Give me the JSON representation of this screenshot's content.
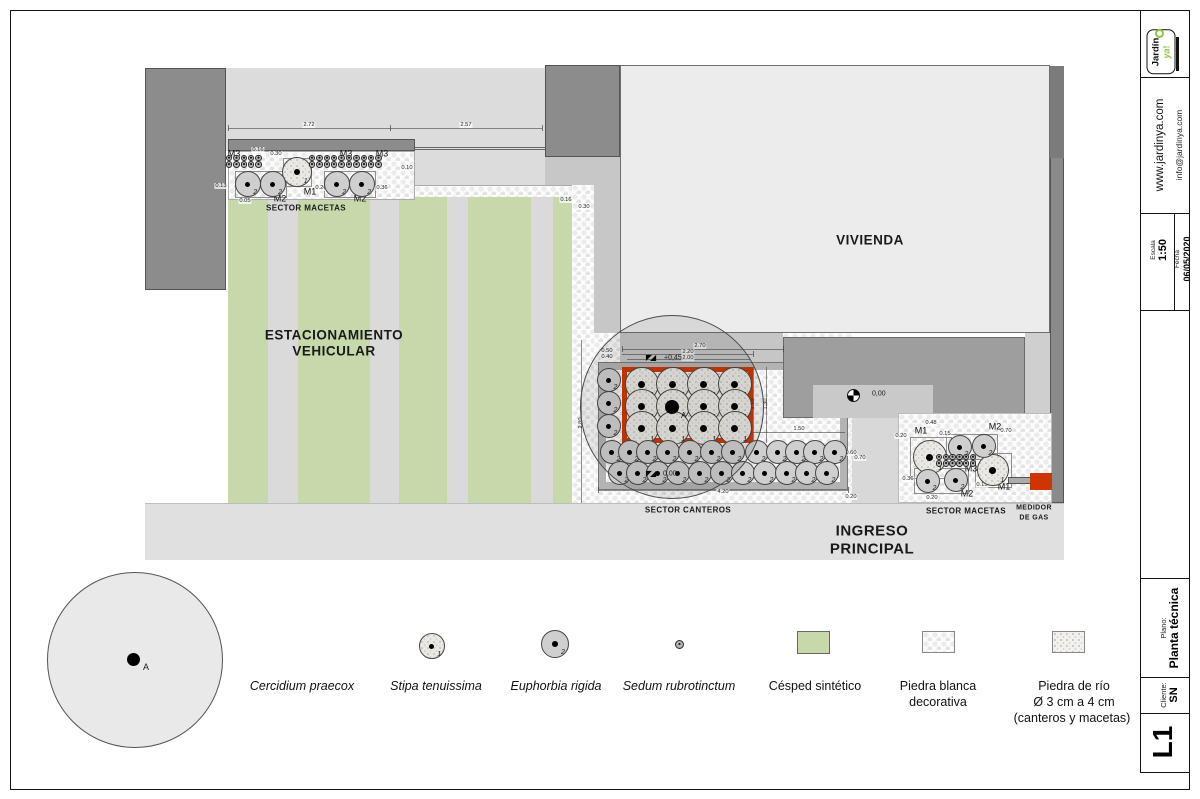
{
  "title_block": {
    "logo_text": "Jardín",
    "logo_accent": "ya",
    "logo_bang": "!",
    "website": "www.jardinya.com",
    "email": "info@jardinya.com",
    "escala_label": "Escala",
    "escala_value": "1:50",
    "fecha_label": "Fecha",
    "fecha_value": "06/05/2020",
    "plano_label": "Plano:",
    "plano_value": "Planta técnica",
    "cliente_label": "Cliente:",
    "cliente_value": "SN",
    "sheet_code": "L1",
    "accent_green": "#8dc63f"
  },
  "plan": {
    "areas": {
      "vivienda": "VIVIENDA",
      "est_l1": "ESTACIONAMIENTO",
      "est_l2": "VEHICULAR",
      "ingreso_l1": "INGRESO",
      "ingreso_l2": "PRINCIPAL",
      "sector_macetas_left": "SECTOR MACETAS",
      "sector_canteros": "SECTOR CANTEROS",
      "sector_macetas_right": "SECTOR MACETAS",
      "medidor_l1": "MEDIDOR",
      "medidor_l2": "DE GAS",
      "tree_tag": "A"
    },
    "colors": {
      "cantero_red": "#cf3500",
      "grass_green": "#c7d9ab"
    },
    "levels": [
      {
        "text": "+0,45",
        "x": 664,
        "y": 358,
        "sym": "tri",
        "sx": 650,
        "sy": 358
      },
      {
        "text": "0,00",
        "x": 663,
        "y": 474,
        "sym": "tri",
        "sx": 650,
        "sy": 474
      },
      {
        "text": "0,00",
        "x": 872,
        "y": 394,
        "sym": "circ",
        "sx": 853,
        "sy": 395
      }
    ],
    "dim_labels": [
      {
        "t": "2.72",
        "x": 309,
        "y": 125
      },
      {
        "t": "2.57",
        "x": 466,
        "y": 125
      },
      {
        "t": "0.16",
        "x": 258,
        "y": 150
      },
      {
        "t": "0.30",
        "x": 276,
        "y": 154
      },
      {
        "t": "0.10",
        "x": 407,
        "y": 168
      },
      {
        "t": "0.13",
        "x": 221,
        "y": 186
      },
      {
        "t": "0.05",
        "x": 245,
        "y": 201
      },
      {
        "t": "0.26",
        "x": 321,
        "y": 188
      },
      {
        "t": "0.36",
        "x": 382,
        "y": 188
      },
      {
        "t": "0.16",
        "x": 566,
        "y": 200
      },
      {
        "t": "0.30",
        "x": 584,
        "y": 207
      },
      {
        "t": "2.70",
        "x": 700,
        "y": 346
      },
      {
        "t": "2.20",
        "x": 688,
        "y": 352
      },
      {
        "t": "2.00",
        "x": 688,
        "y": 358
      },
      {
        "t": "0.50",
        "x": 607,
        "y": 351
      },
      {
        "t": "0.40",
        "x": 607,
        "y": 357
      },
      {
        "t": "2.80",
        "x": 581,
        "y": 423,
        "v": 1
      },
      {
        "t": "1.10",
        "x": 753,
        "y": 404,
        "v": 1
      },
      {
        "t": "1.30",
        "x": 766,
        "y": 404,
        "v": 1
      },
      {
        "t": "1.50",
        "x": 799,
        "y": 429
      },
      {
        "t": "0.60",
        "x": 851,
        "y": 453
      },
      {
        "t": "0.70",
        "x": 860,
        "y": 458
      },
      {
        "t": "4.20",
        "x": 723,
        "y": 492
      },
      {
        "t": "0.20",
        "x": 851,
        "y": 497
      },
      {
        "t": "0.48",
        "x": 931,
        "y": 423
      },
      {
        "t": "0.20",
        "x": 901,
        "y": 436
      },
      {
        "t": "0.15",
        "x": 945,
        "y": 434
      },
      {
        "t": "0.70",
        "x": 1006,
        "y": 431
      },
      {
        "t": "0.36",
        "x": 908,
        "y": 479
      },
      {
        "t": "0.20",
        "x": 932,
        "y": 498
      },
      {
        "t": "0.15",
        "x": 982,
        "y": 485
      }
    ],
    "m_labels": [
      {
        "t": "M3",
        "x": 234,
        "y": 154
      },
      {
        "t": "M3",
        "x": 346,
        "y": 154
      },
      {
        "t": "M3",
        "x": 382,
        "y": 154
      },
      {
        "t": "M2",
        "x": 280,
        "y": 199
      },
      {
        "t": "M1",
        "x": 310,
        "y": 192
      },
      {
        "t": "M2",
        "x": 360,
        "y": 199
      },
      {
        "t": "M1",
        "x": 921,
        "y": 431
      },
      {
        "t": "M2",
        "x": 995,
        "y": 427
      },
      {
        "t": "M3",
        "x": 971,
        "y": 469
      },
      {
        "t": "M2",
        "x": 967,
        "y": 494
      },
      {
        "t": "M1",
        "x": 1004,
        "y": 487
      }
    ],
    "pots": [
      {
        "x": 297,
        "y": 172,
        "r": 15,
        "n": "1",
        "t": "s"
      },
      {
        "x": 248,
        "y": 184,
        "r": 13,
        "n": "2",
        "t": "e"
      },
      {
        "x": 273,
        "y": 184,
        "r": 13,
        "n": "2",
        "t": "e"
      },
      {
        "x": 337,
        "y": 184,
        "r": 13,
        "n": "2",
        "t": "e"
      },
      {
        "x": 362,
        "y": 184,
        "r": 13,
        "n": "2",
        "t": "e"
      },
      {
        "x": 609,
        "y": 380,
        "r": 12,
        "n": "2",
        "t": "e"
      },
      {
        "x": 609,
        "y": 403,
        "r": 12,
        "n": "2",
        "t": "e"
      },
      {
        "x": 609,
        "y": 426,
        "r": 12,
        "n": "2",
        "t": "e"
      },
      {
        "x": 930,
        "y": 457,
        "r": 17,
        "n": "1",
        "t": "s"
      },
      {
        "x": 993,
        "y": 470,
        "r": 16,
        "n": "1",
        "t": "s"
      },
      {
        "x": 960,
        "y": 447,
        "r": 12,
        "n": "2",
        "t": "e"
      },
      {
        "x": 984,
        "y": 446,
        "r": 12,
        "n": "2",
        "t": "e"
      },
      {
        "x": 928,
        "y": 481,
        "r": 12,
        "n": "2",
        "t": "e"
      },
      {
        "x": 956,
        "y": 480,
        "r": 12,
        "n": "2",
        "t": "e"
      }
    ],
    "stipa_grid": {
      "cols": [
        642,
        673,
        704,
        735
      ],
      "rows": [
        384,
        406,
        428
      ],
      "r": 17,
      "label": "1"
    },
    "euphorbia_rows": {
      "r": 12,
      "label": "2",
      "rows": [
        {
          "y": 452,
          "xs": [
            612,
            630,
            648,
            668,
            690,
            712,
            733,
            757,
            778,
            797,
            815,
            835
          ]
        },
        {
          "y": 473,
          "xs": [
            620,
            638,
            658,
            678,
            700,
            722,
            743,
            765,
            787,
            807,
            827
          ]
        }
      ]
    },
    "sedum_clusters": [
      {
        "x": 229,
        "y": 158,
        "cols": 5,
        "rows": 2,
        "dx": 7.4,
        "dy": 6.6,
        "r": 3.3
      },
      {
        "x": 312,
        "y": 158,
        "cols": 10,
        "rows": 2,
        "dx": 7.4,
        "dy": 6.6,
        "r": 3.3
      },
      {
        "x": 939,
        "y": 457,
        "cols": 6,
        "rows": 2,
        "dx": 6.8,
        "dy": 6.6,
        "r": 3.3
      }
    ]
  },
  "legend": {
    "tree_tag": "A",
    "items": [
      {
        "num": "",
        "label": "Cercidium praecox"
      },
      {
        "num": "1",
        "label": "Stipa tenuissima"
      },
      {
        "num": "2",
        "label": "Euphorbia rigida"
      },
      {
        "num": "",
        "label": "Sedum rubrotinctum"
      },
      {
        "num": "",
        "label": "Césped sintético"
      },
      {
        "num": "",
        "label1": "Piedra blanca",
        "label2": "decorativa"
      },
      {
        "num": "",
        "label1": "Piedra de río",
        "label2": "Ø 3 cm a 4 cm",
        "label3": "(canteros y macetas)"
      }
    ]
  }
}
